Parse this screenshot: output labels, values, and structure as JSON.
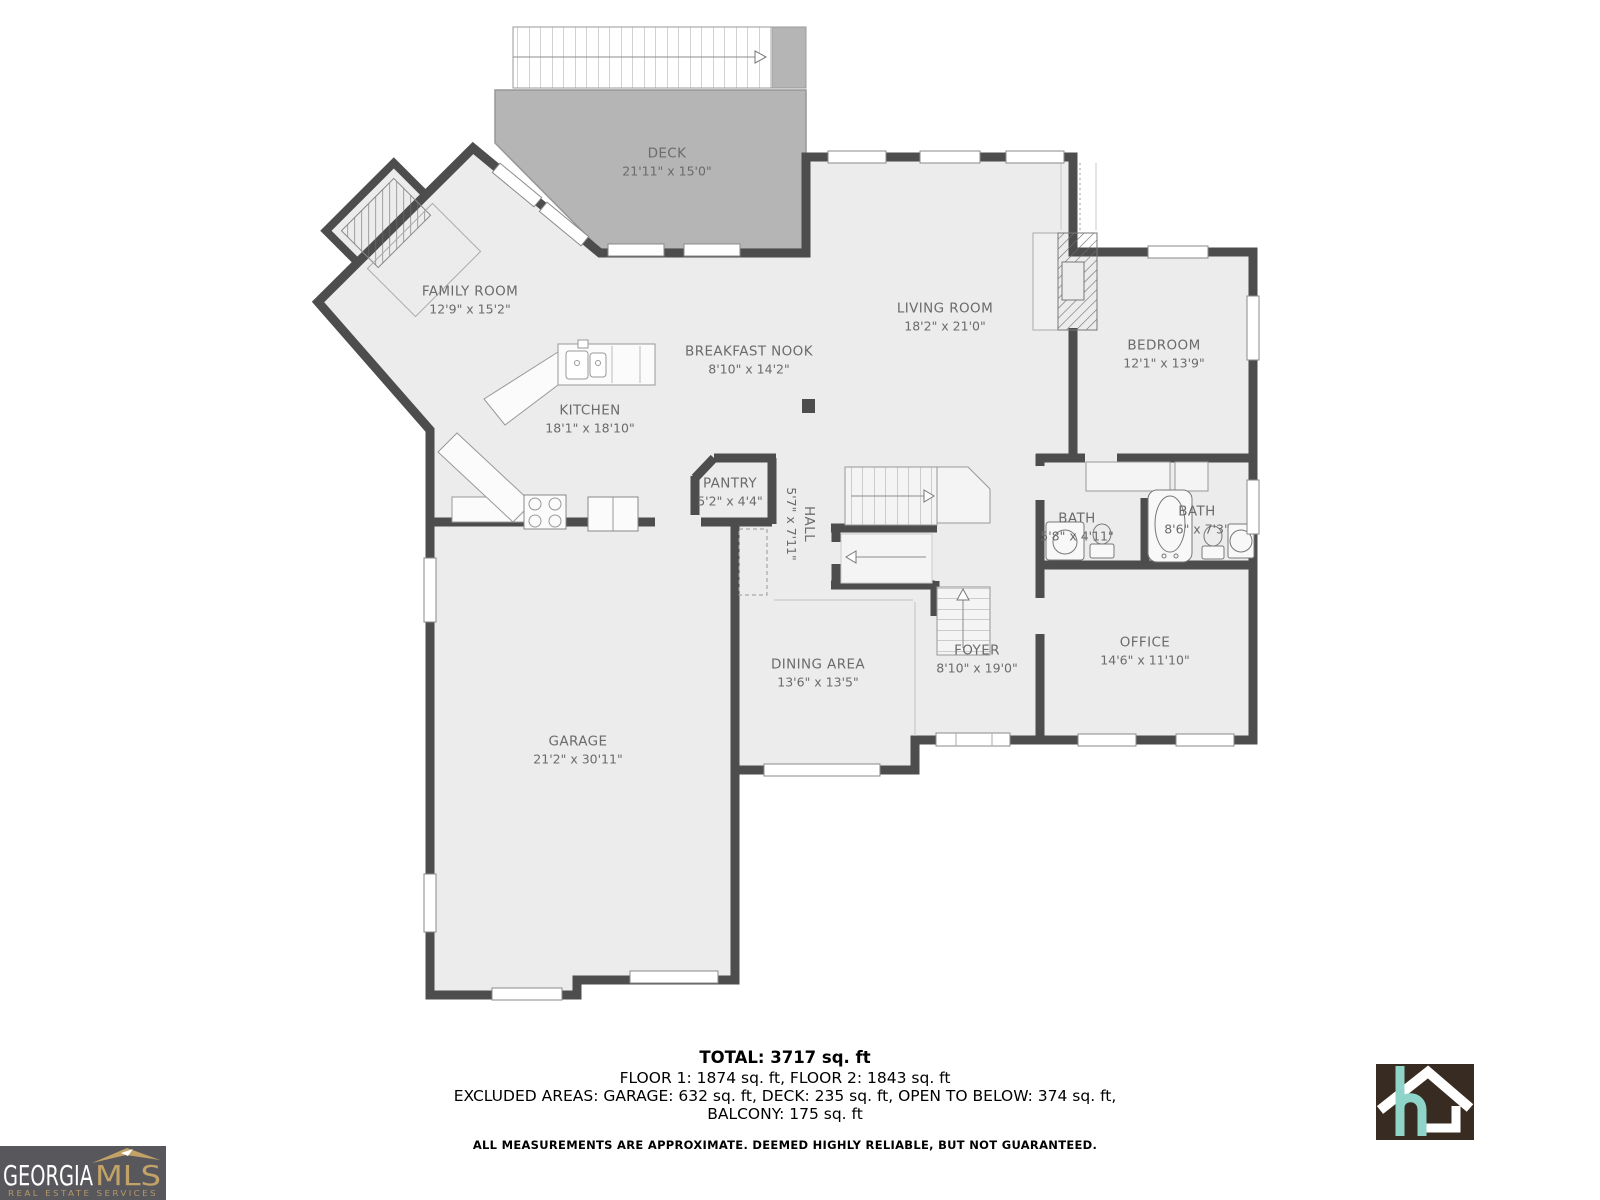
{
  "plan": {
    "rooms": [
      {
        "id": "deck",
        "name": "DECK",
        "dims": "21'11\" x 15'0\""
      },
      {
        "id": "family-room",
        "name": "FAMILY ROOM",
        "dims": "12'9\" x 15'2\""
      },
      {
        "id": "breakfast-nook",
        "name": "BREAKFAST NOOK",
        "dims": "8'10\" x 14'2\""
      },
      {
        "id": "living-room",
        "name": "LIVING ROOM",
        "dims": "18'2\" x 21'0\""
      },
      {
        "id": "bedroom",
        "name": "BEDROOM",
        "dims": "12'1\" x 13'9\""
      },
      {
        "id": "kitchen",
        "name": "KITCHEN",
        "dims": "18'1\" x 18'10\""
      },
      {
        "id": "pantry",
        "name": "PANTRY",
        "dims": "5'2\" x 4'4\""
      },
      {
        "id": "hall",
        "name": "HALL",
        "dims": "5'7\" x 7'11\""
      },
      {
        "id": "bath-1",
        "name": "BATH",
        "dims": "5'8\" x 4'11\""
      },
      {
        "id": "bath-2",
        "name": "BATH",
        "dims": "8'6\" x 7'3\""
      },
      {
        "id": "office",
        "name": "OFFICE",
        "dims": "14'6\" x 11'10\""
      },
      {
        "id": "foyer",
        "name": "FOYER",
        "dims": "8'10\" x 19'0\""
      },
      {
        "id": "dining-area",
        "name": "DINING AREA",
        "dims": "13'6\" x 13'5\""
      },
      {
        "id": "garage",
        "name": "GARAGE",
        "dims": "21'2\" x 30'11\""
      }
    ]
  },
  "footer": {
    "total": "TOTAL: 3717 sq. ft",
    "floors": "FLOOR 1: 1874 sq. ft, FLOOR 2: 1843 sq. ft",
    "excluded": "EXCLUDED AREAS: GARAGE: 632 sq. ft, DECK: 235 sq. ft, OPEN TO BELOW: 374 sq. ft,",
    "balcony": "BALCONY: 175 sq. ft",
    "disclaimer": "ALL MEASUREMENTS ARE APPROXIMATE. DEEMED HIGHLY RELIABLE, BUT NOT GUARANTEED."
  },
  "branding": {
    "georgia_mls": {
      "name_primary": "GEORGIA",
      "name_secondary": "MLS",
      "tagline": "REAL ESTATE SERVICES"
    },
    "home_logo": {
      "letter": "h"
    }
  },
  "colors": {
    "wall": "#4d4d4d",
    "floor": "#ececec",
    "deck": "#b5b5b5",
    "label_text": "#6b6b6b",
    "mls_bg": "#58585c",
    "mls_gold": "#c2a267",
    "home_logo_bg": "#382b21",
    "home_logo_teal": "#8fd4c8"
  }
}
